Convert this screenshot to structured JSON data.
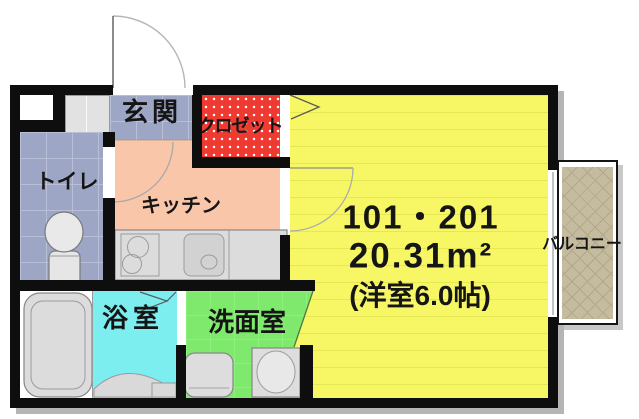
{
  "unit": {
    "numbers": "101・201",
    "area": "20.31m²",
    "size_note": "(洋室6.0帖)"
  },
  "rooms": {
    "genkan": {
      "label": "玄関",
      "color": "#9ea6c6"
    },
    "closet": {
      "label": "クロゼット",
      "color": "#ee3a30"
    },
    "toilet": {
      "label": "トイレ",
      "color": "#9ea6c6"
    },
    "kitchen": {
      "label": "キッチン",
      "color": "#f9c6aa"
    },
    "bathroom": {
      "label": "浴室",
      "color": "#7deef0"
    },
    "washroom": {
      "label": "洗面室",
      "color": "#7ee96d"
    },
    "main_room": {
      "label": "",
      "color": "#f7f765"
    },
    "balcony": {
      "label": "バルコニー",
      "color": "#c5bca0"
    }
  },
  "fixtures": {
    "entrance_door": "entrance-door-swing",
    "toilet": "toilet-fixture",
    "kitchen_counter": "kitchen-counter-with-burners-and-sink",
    "bathtub": "bathtub",
    "washing_machine": "washing-machine-pan",
    "vanity": "vanity-sink"
  },
  "wall_color": "#0e0e0e"
}
